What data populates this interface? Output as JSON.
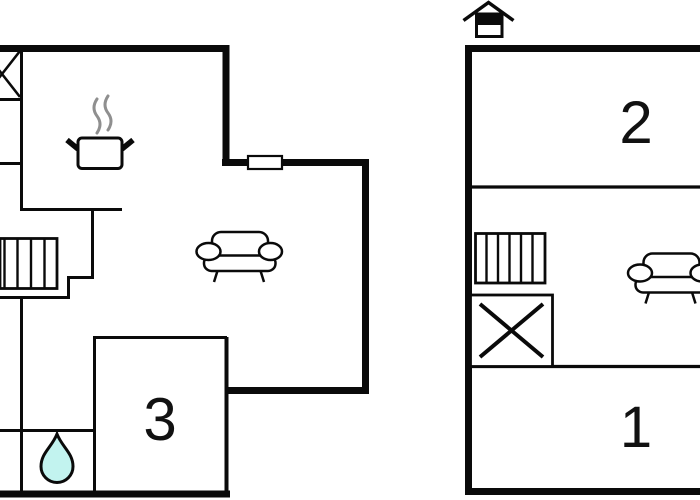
{
  "canvas": {
    "width": 700,
    "height": 500,
    "background": "#ffffff"
  },
  "colors": {
    "wall": "#0a0a0a",
    "interior_wall": "#121212",
    "furniture_line": "#111111",
    "steam": "#8f8f8f",
    "water_drop_fill": "#c2f3ef",
    "white_fill": "#ffffff",
    "label_text": "#111111"
  },
  "ground_floor": {
    "name": "ground-floor-plan",
    "room_labels": {
      "room3": "3"
    },
    "symbols": [
      "wardrobe-x-icon",
      "closet-shelves",
      "stairs-icon",
      "stove-pot-icon",
      "steam-icon",
      "window",
      "sofa-icon",
      "water-drop-icon"
    ]
  },
  "upper_floor": {
    "name": "upper-floor-plan",
    "room_labels": {
      "room1": "1",
      "room2": "2"
    },
    "symbols": [
      "attic-house-icon",
      "stairs-icon",
      "storage-x-icon",
      "sofa-icon"
    ]
  }
}
